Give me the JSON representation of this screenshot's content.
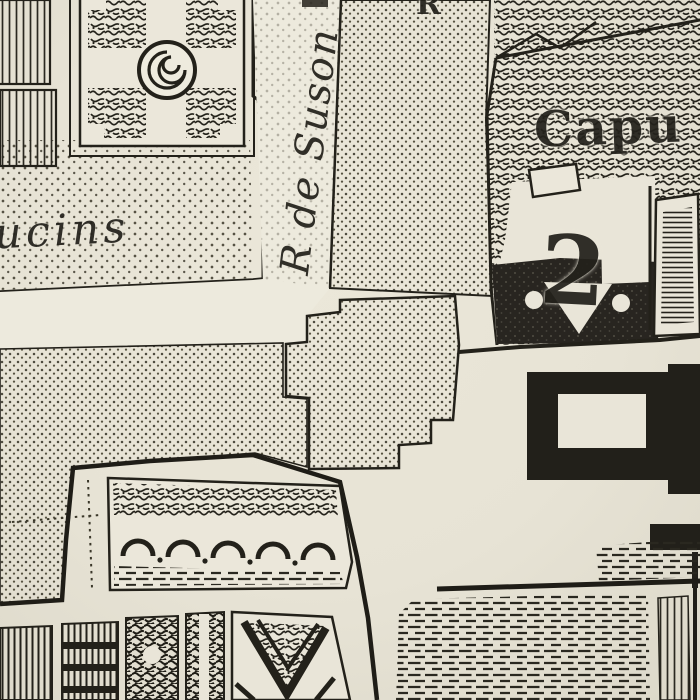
{
  "map": {
    "labels": {
      "convent_left_partial": "ucins",
      "street_vertical": "R de Suson",
      "convent_right_partial": "Capu",
      "street_top_partial": "R",
      "reference_numeral": "2"
    },
    "colors": {
      "paper": "#e8e4d6",
      "ink": "#23211a",
      "dark_building": "#22201a",
      "street": "#edeadd"
    }
  }
}
